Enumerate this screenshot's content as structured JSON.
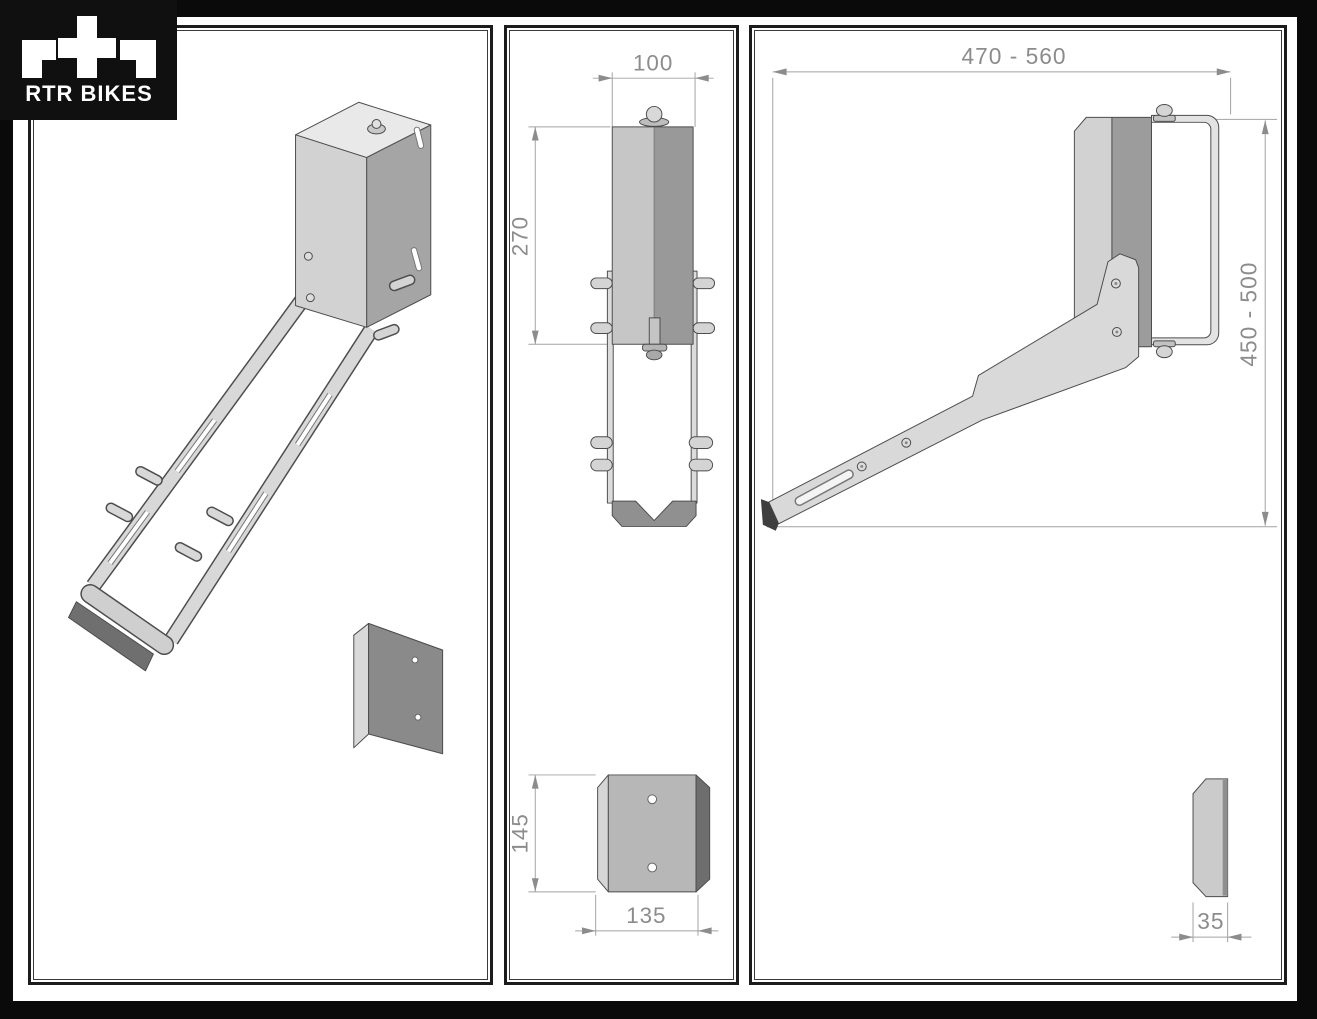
{
  "logo": {
    "brand": "RTR BIKES"
  },
  "colors": {
    "frame": "#0a0a0a",
    "panel_background": "#ffffff",
    "part_outline": "#4d4d4d",
    "dimension_line": "#a2a2a2",
    "dimension_text": "#8c8c8c",
    "part_light": "#d6d6d6",
    "part_mid": "#a8a8a8",
    "part_dark": "#6f6f6f"
  },
  "front_view": {
    "dim_body_width": "100",
    "dim_body_height": "270",
    "dim_plate_height": "145",
    "dim_plate_width": "135"
  },
  "side_view": {
    "dim_reach": "470 - 560",
    "dim_height": "450 - 500",
    "dim_plate_depth": "35"
  }
}
